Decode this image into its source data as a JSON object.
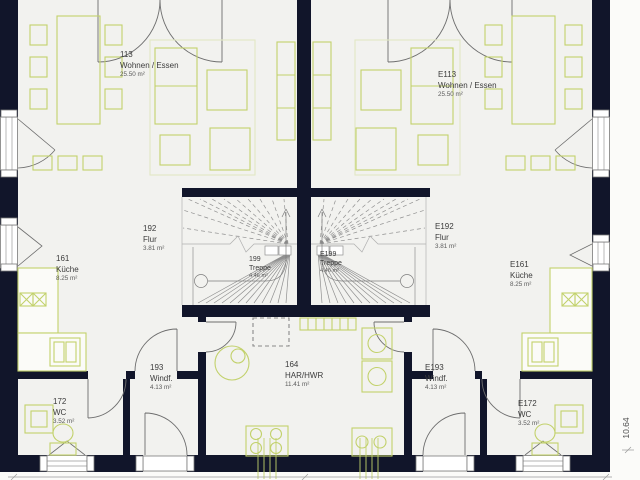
{
  "rooms": {
    "r113": {
      "number": "113",
      "name": "Wohnen / Essen",
      "area": "25.50 m²"
    },
    "e113": {
      "number": "E113",
      "name": "Wohnen / Essen",
      "area": "25.50 m²"
    },
    "r192": {
      "number": "192",
      "name": "Flur",
      "area": "3.81 m²"
    },
    "e192": {
      "number": "E192",
      "name": "Flur",
      "area": "3.81 m²"
    },
    "r161": {
      "number": "161",
      "name": "Küche",
      "area": "8.25 m²"
    },
    "e161": {
      "number": "E161",
      "name": "Küche",
      "area": "8.25 m²"
    },
    "r199": {
      "number": "199",
      "name": "Treppe",
      "area": "4.46 m²"
    },
    "e199": {
      "number": "E199",
      "name": "Treppe",
      "area": "4.46 m²"
    },
    "r193": {
      "number": "193",
      "name": "Windf.",
      "area": "4.13 m²"
    },
    "e193": {
      "number": "E193",
      "name": "Windf.",
      "area": "4.13 m²"
    },
    "r172": {
      "number": "172",
      "name": "WC",
      "area": "3.52 m²"
    },
    "e172": {
      "number": "E172",
      "name": "WC",
      "area": "3.52 m²"
    },
    "r164": {
      "number": "164",
      "name": "HAR/HWR",
      "area": "11.41 m²"
    }
  },
  "dimensions": {
    "vertical_total": "10.64"
  },
  "colors": {
    "wall": "#11152a",
    "furniture": "#c2d16b",
    "floor": "#f2f2ef",
    "door_line": "#6e6e6e",
    "stair_line": "#909090"
  }
}
